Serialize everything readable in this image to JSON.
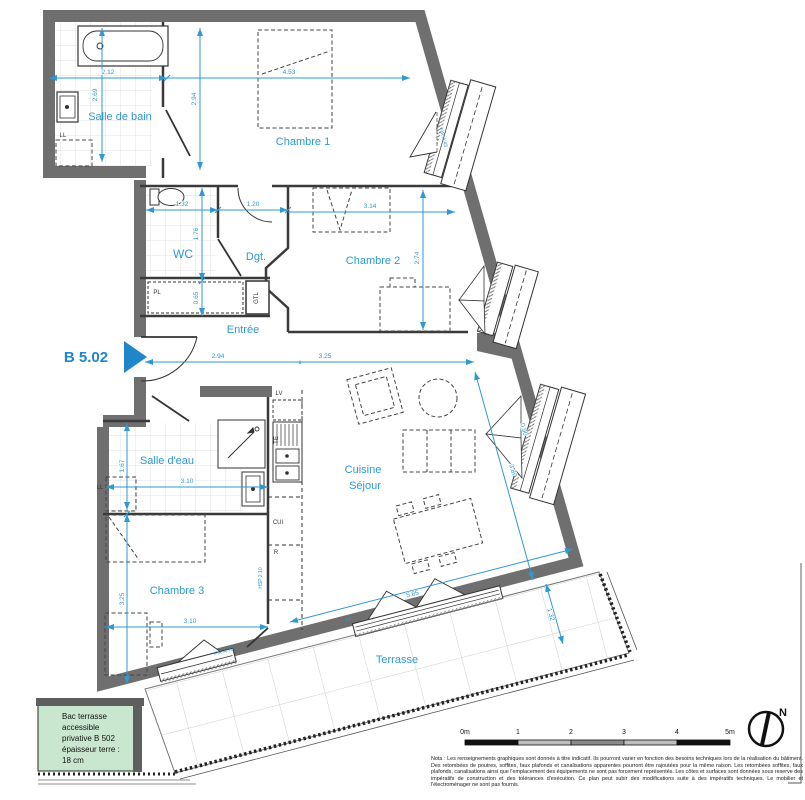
{
  "colors": {
    "accent": "#2f99d1",
    "wall": "#6f6f6f",
    "planter_green": "#c9e7cf"
  },
  "unit": {
    "id": "B 5.02"
  },
  "rooms": {
    "salle_de_bain": "Salle de bain",
    "chambre1": "Chambre 1",
    "wc": "WC",
    "dgt": "Dgt.",
    "chambre2": "Chambre 2",
    "entree": "Entrée",
    "salle_deau": "Salle d'eau",
    "cuisine": "Cuisine",
    "sejour": "Séjour",
    "chambre3": "Chambre 3",
    "terrasse": "Terrasse"
  },
  "dims": {
    "sdb_w": "2.12",
    "sdb_h": "2.69",
    "ch1_w": "4.53",
    "ch1_h": "2.94",
    "wc_w": "1.32",
    "dgt_w": "1.20",
    "ch2_w": "3.14",
    "wc_h": "1.76",
    "gtl_h": "0.65",
    "ch2_h": "2.74",
    "entree_w": "2.94",
    "sejour_w": "3.25",
    "sde_h": "1.67",
    "sde_w": "3.10",
    "sejour_diag": "3.87",
    "bay_w": "0.90",
    "ch3_h": "3.25",
    "ch3_w": "3.10",
    "sejour_bottom": "5.85",
    "terrasse_w": "1.32",
    "break_mark": "*"
  },
  "fixtures": {
    "washer1": "LL",
    "washer2": "LL",
    "closet": "PL",
    "duct": "GTL",
    "dishwasher": "LV",
    "sink": "TE",
    "cooker": "CUI",
    "fridge": "R",
    "ceiling_height": "HSP 2.10",
    "bay_door": "PF",
    "window_ch3": "F\\R.A:70",
    "window_ch1": "F\\R.A:43"
  },
  "legend": {
    "line1": "Bac terrasse",
    "line2": "accessible",
    "line3": "privative B 502",
    "line4": "épaisseur terre :",
    "line5": "18 cm"
  },
  "scalebar": {
    "t0": "0m",
    "t1": "1",
    "t2": "2",
    "t3": "3",
    "t4": "4",
    "t5": "5m"
  },
  "north": {
    "label": "N"
  },
  "nota": "Nota : Les renseignements graphiques sont donnés à titre indicatif. Ils pourront varier en fonction des besoins techniques lors de la réalisation du bâtiment. Des retombées de poutres, soffites, faux plafonds et canalisations apparentes pourront être rajoutées pour la même raison. Les retombées soffites, faux plafonds, canalisations ainsi que l'emplacement des équipements ne sont pas forcement représentés. Les côtes et surfaces sont données sous reserve des impératifs de construction et des tolérances d'exécution. Ce plan peut subir des modifications suite à des impératifs techniques. Le mobilier et l'électroménager ne sont pas fournis."
}
